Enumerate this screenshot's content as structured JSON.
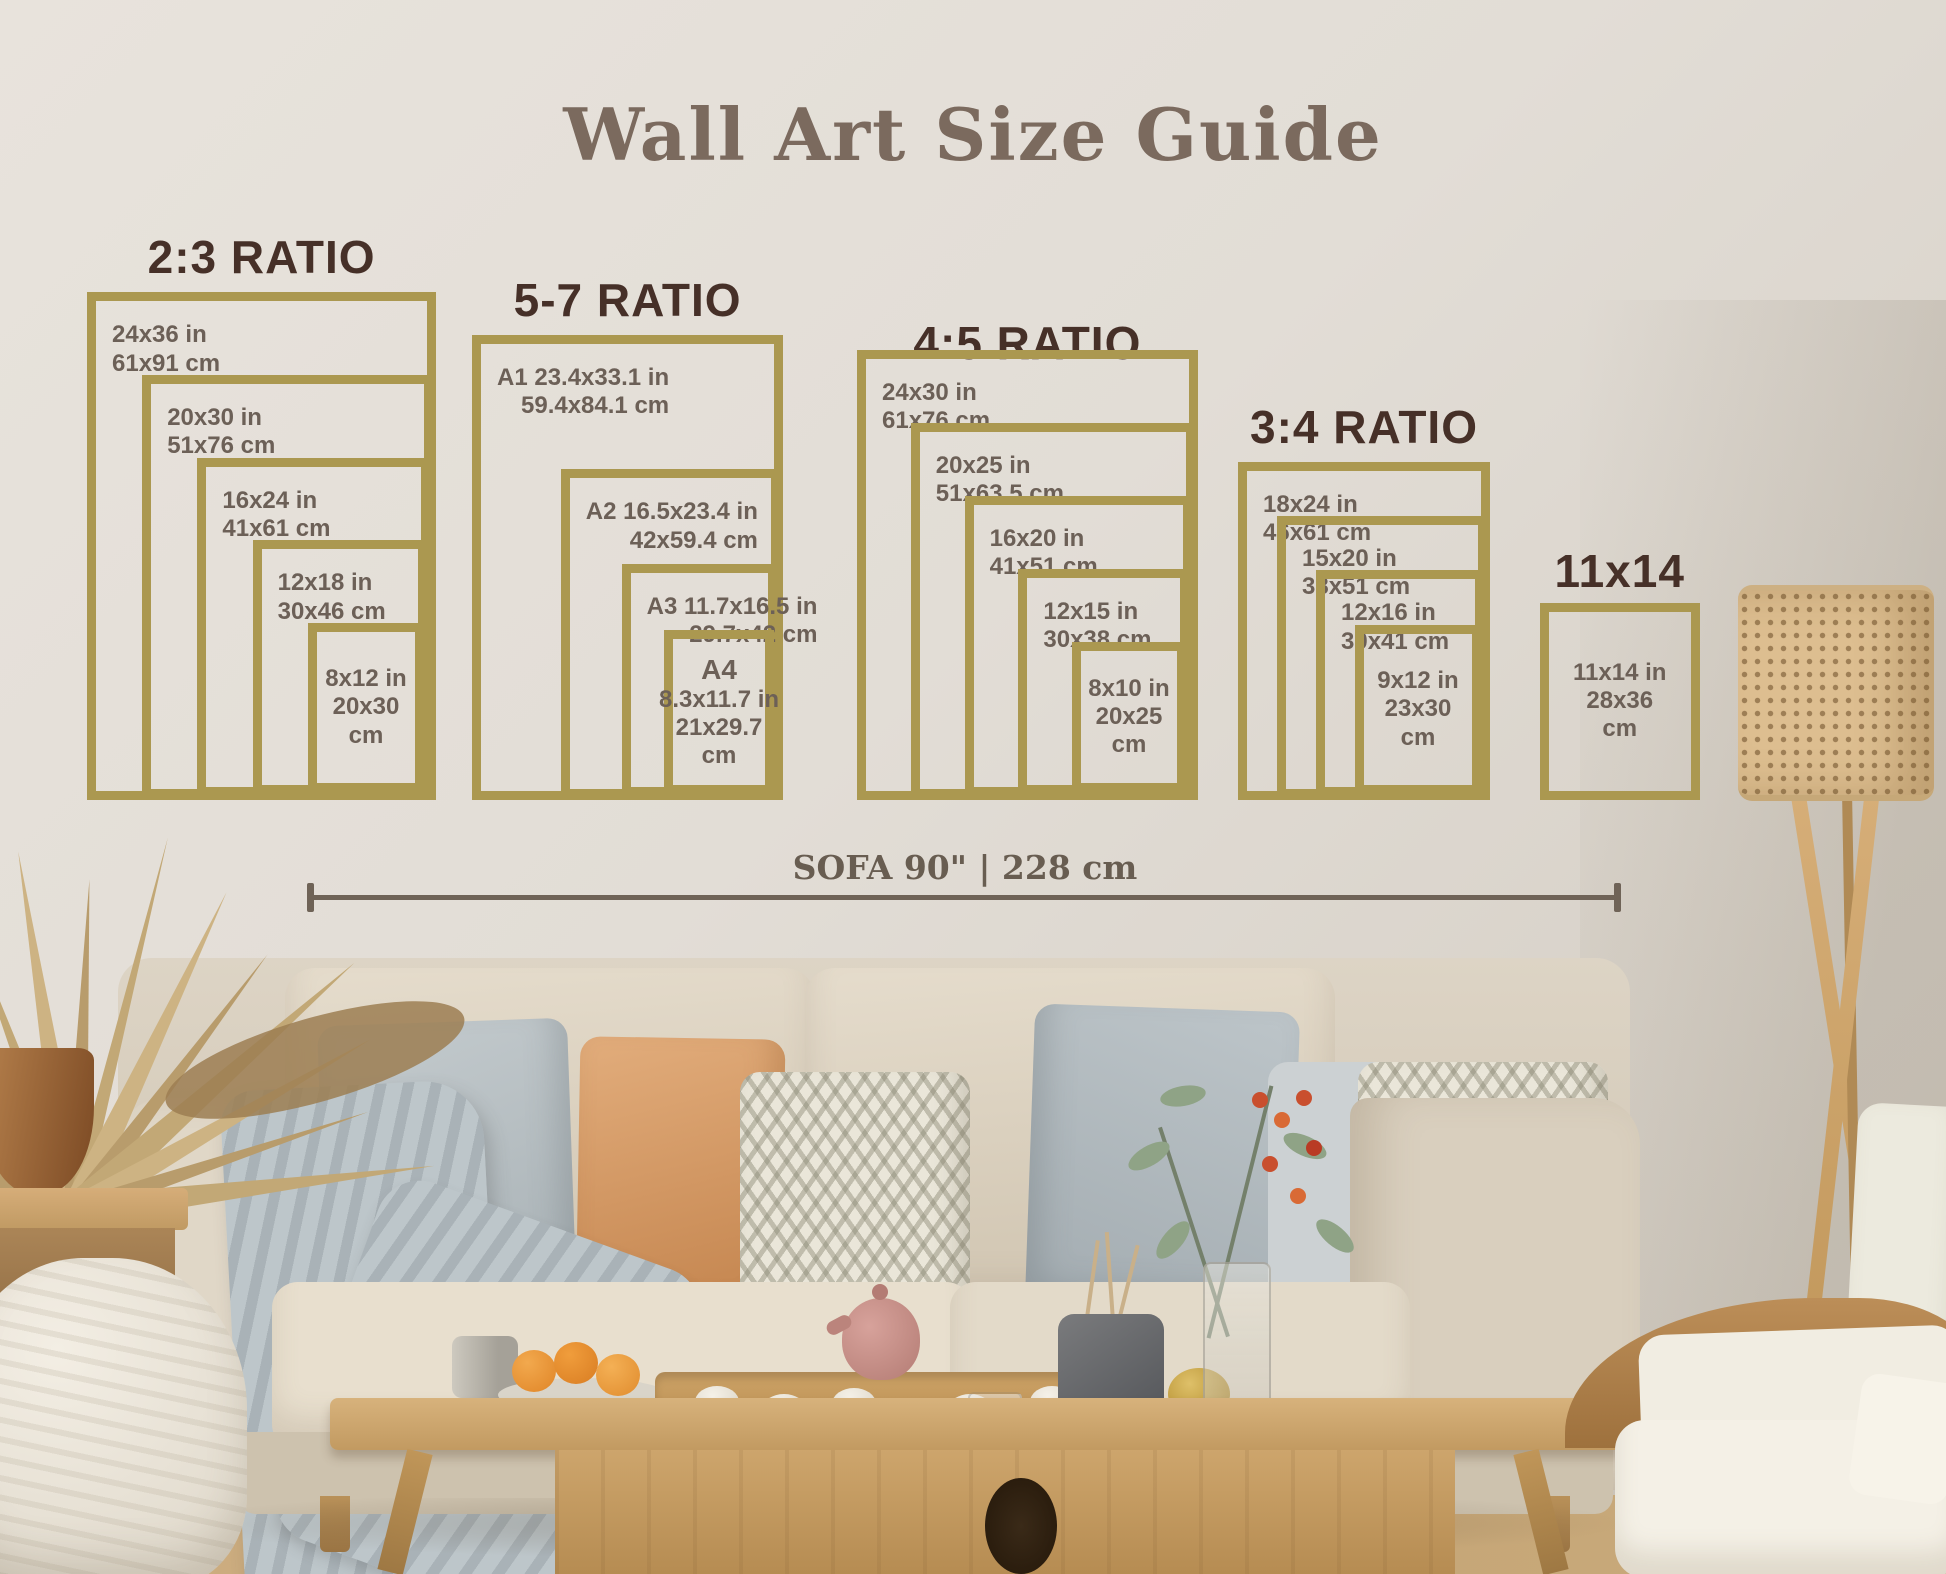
{
  "palette": {
    "gold": "#ab9850",
    "heading": "#7b6a5e",
    "ratio-title": "#463028",
    "size-label": "#6c6057",
    "measure": "#6f6357",
    "wall": "#e2ddd6",
    "sofa": "#ddd3c3",
    "pillow-gray": "#b7bec2",
    "pillow-terracotta": "#d79d6e",
    "pillow-chevron": "#eae6d9",
    "blanket": "#b3bcc0",
    "wood": "#c9a268",
    "lamp-cane": "#ddbe90",
    "plant-tan": "#c2a876",
    "greenery": "#8fa386",
    "berry": "#c94f2e"
  },
  "header": {
    "title": "Wall Art Size Guide"
  },
  "size_guide": {
    "groups": [
      {
        "id": "2-3",
        "title": "2:3 RATIO",
        "frames": [
          {
            "w_in": 24,
            "h_in": 36,
            "lines": [
              "24x36 in",
              "61x91 cm"
            ]
          },
          {
            "w_in": 20,
            "h_in": 30,
            "lines": [
              "20x30 in",
              "51x76 cm"
            ]
          },
          {
            "w_in": 16,
            "h_in": 24,
            "lines": [
              "16x24 in",
              "41x61 cm"
            ]
          },
          {
            "w_in": 12,
            "h_in": 18,
            "lines": [
              "12x18 in",
              "30x46 cm"
            ]
          },
          {
            "w_in": 8,
            "h_in": 12,
            "lines": [
              "8x12 in",
              "20x30",
              "cm"
            ],
            "centered": true
          }
        ]
      },
      {
        "id": "5-7",
        "title": "5-7 RATIO",
        "frames": [
          {
            "w_in": 23.4,
            "h_in": 33.1,
            "lines": [
              "A1 23.4x33.1 in",
              "59.4x84.1 cm"
            ]
          },
          {
            "w_in": 16.5,
            "h_in": 23.4,
            "lines": [
              "A2 16.5x23.4 in",
              "42x59.4 cm"
            ]
          },
          {
            "w_in": 11.7,
            "h_in": 16.5,
            "lines": [
              "A3 11.7x16.5 in",
              "29.7x42 cm"
            ]
          },
          {
            "w_in": 8.3,
            "h_in": 11.7,
            "lines": [
              "A4",
              "8.3x11.7 in",
              "21x29.7",
              "cm"
            ],
            "centered": true,
            "big_first": true
          }
        ]
      },
      {
        "id": "4-5",
        "title": "4:5 RATIO",
        "frames": [
          {
            "w_in": 24,
            "h_in": 30,
            "lines": [
              "24x30 in",
              "61x76 cm"
            ]
          },
          {
            "w_in": 20,
            "h_in": 25,
            "lines": [
              "20x25 in",
              "51x63.5 cm"
            ]
          },
          {
            "w_in": 16,
            "h_in": 20,
            "lines": [
              "16x20 in",
              "41x51 cm"
            ]
          },
          {
            "w_in": 12,
            "h_in": 15,
            "lines": [
              "12x15 in",
              "30x38 cm"
            ]
          },
          {
            "w_in": 8,
            "h_in": 10,
            "lines": [
              "8x10 in",
              "20x25",
              "cm"
            ],
            "centered": true
          }
        ]
      },
      {
        "id": "3-4",
        "title": "3:4 RATIO",
        "frames": [
          {
            "w_in": 18,
            "h_in": 24,
            "lines": [
              "18x24 in",
              "46x61 cm"
            ]
          },
          {
            "w_in": 15,
            "h_in": 20,
            "lines": [
              "15x20 in",
              "38x51 cm"
            ]
          },
          {
            "w_in": 12,
            "h_in": 16,
            "lines": [
              "12x16 in",
              "30x41 cm"
            ]
          },
          {
            "w_in": 9,
            "h_in": 12,
            "lines": [
              "9x12 in",
              "23x30",
              "cm"
            ],
            "centered": true
          }
        ]
      },
      {
        "id": "11x14",
        "title": "11x14",
        "frames": [
          {
            "w_in": 11,
            "h_in": 14,
            "lines": [
              "11x14 in",
              "28x36",
              "cm"
            ],
            "centered": true
          }
        ]
      }
    ]
  },
  "sofa_measure": {
    "label": "SOFA 90\" | 228 cm"
  }
}
